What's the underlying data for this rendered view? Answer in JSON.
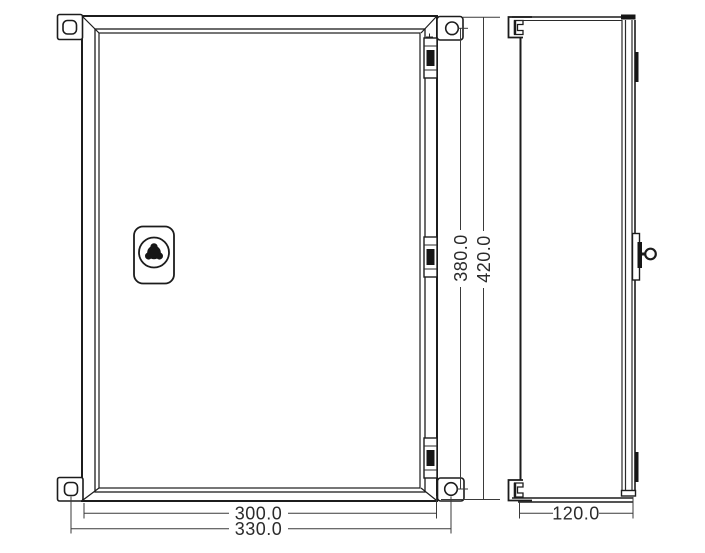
{
  "drawing": {
    "kind": "enclosure-technical-drawing",
    "views": {
      "front": "front-view-of-enclosure-with-door-lock-hinges-and-mounting-brackets",
      "side": "side-view-of-enclosure-depth"
    }
  },
  "dimensions": {
    "vertical_hole_spacing": "380.0",
    "vertical_overall": "420.0",
    "horizontal_body_width": "300.0",
    "horizontal_hole_spacing": "330.0",
    "depth": "120.0"
  },
  "colors": {
    "outline": "#1c1c1c",
    "dimension_line": "#3a3a3a",
    "dimension_text": "#2b2b2b",
    "background": "#ffffff"
  }
}
